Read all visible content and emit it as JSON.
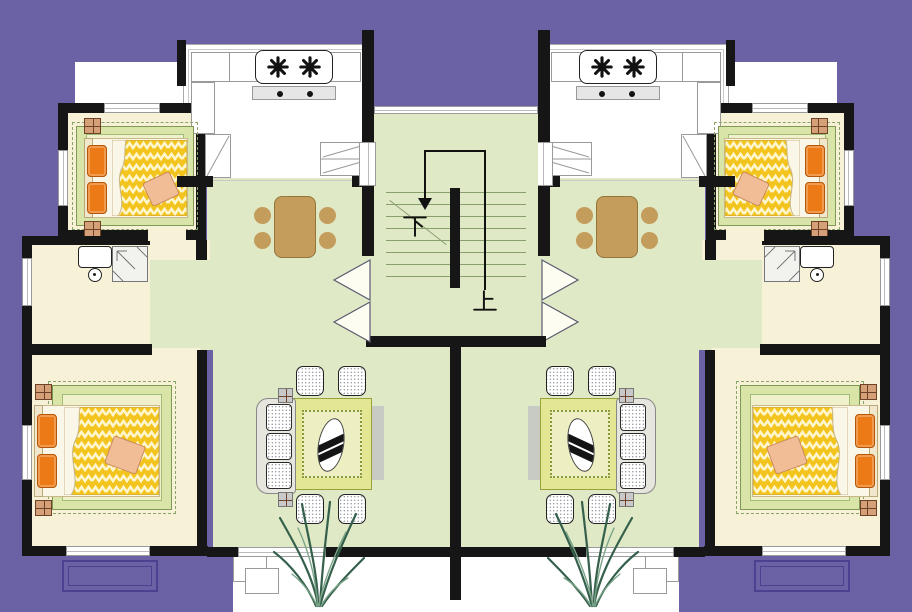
{
  "stairwell": {
    "down_label": "下",
    "up_label": "上",
    "step_count": 8
  },
  "colors": {
    "bg": "#6A62A5",
    "wall": "#161616",
    "room-cream": "#F7F1D8",
    "room-green": "#DFE9C6",
    "rug-green": "#D9E5A8",
    "rug-inner": "#F0F1CC",
    "blanket-yellow": "#F2C41D",
    "blanket-zigzag": "#FFF6CE",
    "pillow-orange": "#EC7A16",
    "table-brown": "#C49C5C",
    "living-rug": "#E3E794",
    "stair-line": "#8A9F6E",
    "balcony-outline": "#4A4291",
    "plant-green": "#35604C"
  }
}
